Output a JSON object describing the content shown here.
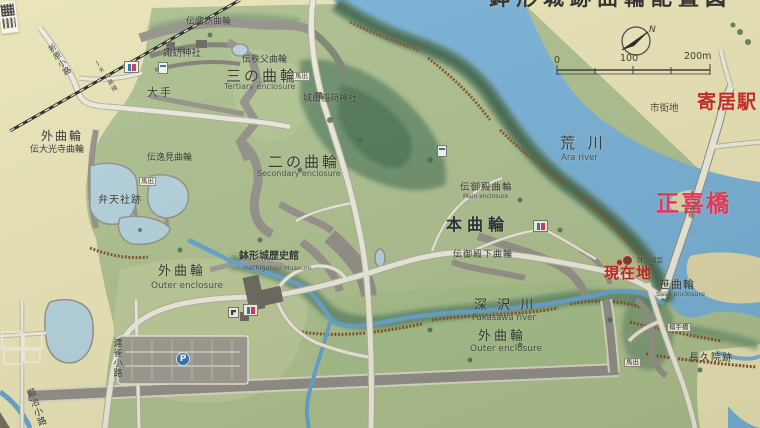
{
  "sign": {
    "type": "castle-site-guide-map"
  },
  "compass": {
    "north_label": "N"
  },
  "scale_bar": {
    "ticks": [
      "0",
      "100",
      "200m"
    ]
  },
  "icons": {
    "parking_letter": "P"
  },
  "colors": {
    "water": "#72aed8",
    "grass": "#a9bd8c",
    "cream": "#e7e2b4",
    "label_ink": "#262c30",
    "label_red": "#cc1414",
    "station_red": "#c32020",
    "bridge_pink": "#e82e5a"
  },
  "labels": [
    {
      "n": "map-title",
      "t": "鉢形城跡曲輪配置図",
      "x": 489,
      "y": -12,
      "fs": 21,
      "b": 1,
      "ls": 6,
      "c": "#23231f"
    },
    {
      "n": "yorii-station",
      "t": "寄居駅",
      "x": 697,
      "y": 93,
      "fs": 19,
      "b": 1,
      "ls": 1,
      "c": "#c32020"
    },
    {
      "n": "shigaichi",
      "t": "市街地",
      "x": 650,
      "y": 104,
      "fs": 9.5,
      "c": "#3c3a32"
    },
    {
      "n": "arakawa",
      "t": "荒 川",
      "x": 560,
      "y": 136,
      "fs": 15,
      "ls": 4,
      "c": "#25323c"
    },
    {
      "n": "arakawa-en",
      "t": "Ara river",
      "x": 561,
      "y": 154,
      "fs": 8.5,
      "c": "#37464e"
    },
    {
      "n": "shokibashi",
      "t": "正喜橋",
      "x": 656,
      "y": 193,
      "fs": 23,
      "b": 1,
      "ls": 2,
      "c": "#e82e5a"
    },
    {
      "n": "genzaichi",
      "t": "現在地",
      "x": 604,
      "y": 266,
      "fs": 15,
      "b": 1,
      "ls": 1,
      "c": "#cc1414"
    },
    {
      "n": "model-note",
      "t": "鉢形模型",
      "x": 637,
      "y": 257,
      "fs": 6.5,
      "c": "#3a382e"
    },
    {
      "n": "sasa-kuruwa",
      "t": "笹曲輪",
      "x": 659,
      "y": 279,
      "fs": 11,
      "ls": 1
    },
    {
      "n": "sasa-kuruwa-en",
      "t": "Sasa enclosure",
      "x": 656,
      "y": 291,
      "fs": 6.5,
      "c": "#37464e"
    },
    {
      "n": "karamete-bashi",
      "t": "搦手橋",
      "x": 667,
      "y": 323,
      "fs": 6.5,
      "bg": 1
    },
    {
      "n": "chokyuin-ato",
      "t": "長久院跡",
      "x": 689,
      "y": 354,
      "fs": 10,
      "ls": 1
    },
    {
      "n": "umadashi-se",
      "t": "馬出",
      "x": 624,
      "y": 358,
      "fs": 6.5,
      "bg": 1
    },
    {
      "n": "hon-kuruwa",
      "t": "本曲輪",
      "x": 446,
      "y": 217,
      "fs": 16,
      "b": 1,
      "ls": 5,
      "c": "#1b2530"
    },
    {
      "n": "goten-kuruwa",
      "t": "伝御殿曲輪",
      "x": 460,
      "y": 183,
      "fs": 9.5,
      "ls": 1
    },
    {
      "n": "goten-kuruwa-en",
      "t": "Main enclosure",
      "x": 463,
      "y": 194,
      "fs": 6,
      "c": "#37464e"
    },
    {
      "n": "gotenshita-kuruwa",
      "t": "伝御殿下曲輪",
      "x": 453,
      "y": 251,
      "fs": 9,
      "ls": 1
    },
    {
      "n": "ni-no-kuruwa",
      "t": "二の曲輪",
      "x": 268,
      "y": 155,
      "fs": 15,
      "ls": 3
    },
    {
      "n": "ni-no-kuruwa-en",
      "t": "Secondary enclosure",
      "x": 257,
      "y": 170,
      "fs": 8,
      "c": "#37464e"
    },
    {
      "n": "san-no-kuruwa",
      "t": "三の曲輪",
      "x": 226,
      "y": 69,
      "fs": 15,
      "ls": 3
    },
    {
      "n": "san-no-kuruwa-en",
      "t": "Tertiary enclosure",
      "x": 224,
      "y": 83,
      "fs": 8,
      "c": "#37464e"
    },
    {
      "n": "chichibu-kuruwa",
      "t": "伝秩父曲輪",
      "x": 242,
      "y": 56,
      "fs": 9
    },
    {
      "n": "den-suwa-kuruwa",
      "t": "伝諏訪曲輪",
      "x": 186,
      "y": 18,
      "fs": 9
    },
    {
      "n": "suwa-jinja",
      "t": "諏訪神社",
      "x": 163,
      "y": 49,
      "fs": 9.5
    },
    {
      "n": "ote",
      "t": "大手",
      "x": 147,
      "y": 87,
      "fs": 11,
      "ls": 2
    },
    {
      "n": "shiroyama-inari-jinja",
      "t": "城山稲荷神社",
      "x": 303,
      "y": 95,
      "fs": 9
    },
    {
      "n": "umadashi-n",
      "t": "馬出",
      "x": 293,
      "y": 72,
      "fs": 6.5,
      "bg": 1
    },
    {
      "n": "umadashi-w",
      "t": "馬出",
      "x": 139,
      "y": 177,
      "fs": 6.5,
      "bg": 1
    },
    {
      "n": "soto-kuruwa-nw",
      "t": "外曲輪",
      "x": 41,
      "y": 130,
      "fs": 12,
      "ls": 2
    },
    {
      "n": "daikoji-kuruwa",
      "t": "伝大光寺曲輪",
      "x": 30,
      "y": 146,
      "fs": 9
    },
    {
      "n": "henmi-kuruwa",
      "t": "伝逸見曲輪",
      "x": 147,
      "y": 154,
      "fs": 9
    },
    {
      "n": "benten-sha-ato",
      "t": "弁天社跡",
      "x": 98,
      "y": 196,
      "fs": 10,
      "ls": 1
    },
    {
      "n": "soto-kuruwa-w",
      "t": "外曲輪",
      "x": 158,
      "y": 265,
      "fs": 13,
      "ls": 3
    },
    {
      "n": "soto-kuruwa-w-en",
      "t": "Outer enclosure",
      "x": 151,
      "y": 282,
      "fs": 9,
      "c": "#37464e"
    },
    {
      "n": "museum",
      "t": "鉢形城歴史館",
      "x": 239,
      "y": 252,
      "fs": 10,
      "b": 1
    },
    {
      "n": "museum-en",
      "t": "Hachigatajo Museum",
      "x": 243,
      "y": 265,
      "fs": 6.5,
      "c": "#37464e"
    },
    {
      "n": "fukasawa-gawa",
      "t": "深 沢 川",
      "x": 474,
      "y": 299,
      "fs": 13,
      "ls": 3
    },
    {
      "n": "fukasawa-gawa-en",
      "t": "Fukasawa river",
      "x": 472,
      "y": 314,
      "fs": 8.5,
      "c": "#37464e"
    },
    {
      "n": "soto-kuruwa-s",
      "t": "外曲輪",
      "x": 478,
      "y": 330,
      "fs": 13,
      "ls": 3
    },
    {
      "n": "soto-kuruwa-s-en",
      "t": "Outer enclosure",
      "x": 470,
      "y": 345,
      "fs": 9,
      "c": "#37464e"
    },
    {
      "n": "renjaku-koji",
      "t": "連雀小路",
      "x": 111,
      "y": 338,
      "fs": 9,
      "v": 1
    },
    {
      "n": "kaji-koji",
      "t": "鍛冶小路",
      "x": 30,
      "y": 388,
      "fs": 9,
      "v": 1,
      "r": -20
    },
    {
      "n": "orihara-koji",
      "t": "折原小路",
      "x": 55,
      "y": 42,
      "fs": 8,
      "v": 1,
      "r": -32
    },
    {
      "n": "jr-hachiko-line",
      "t": "JR八高線",
      "x": 102,
      "y": 58,
      "fs": 6,
      "v": 1,
      "r": -32,
      "c": "#3a382e"
    },
    {
      "n": "shokibashi-small",
      "t": "正喜橋",
      "x": 688,
      "y": 198,
      "fs": 6,
      "v": 1,
      "r": 15,
      "c": "#3a382e"
    }
  ],
  "markers": [
    {
      "n": "toilet-icon-suwa",
      "type": "toilet",
      "x": 124,
      "y": 61
    },
    {
      "n": "guide-sign-icon-suwa",
      "type": "sign",
      "x": 158,
      "y": 62
    },
    {
      "n": "toilet-icon-honkuruwa",
      "type": "toilet",
      "x": 533,
      "y": 220
    },
    {
      "n": "toilet-icon-museum",
      "type": "toilet",
      "x": 243,
      "y": 304
    },
    {
      "n": "faucet-icon-museum",
      "type": "faucet",
      "x": 228,
      "y": 307
    },
    {
      "n": "parking-icon",
      "type": "parking",
      "x": 176,
      "y": 352
    },
    {
      "n": "you-are-here-dot",
      "type": "here",
      "x": 622,
      "y": 255
    },
    {
      "n": "viewpoint-marker",
      "type": "sign",
      "x": 437,
      "y": 145
    }
  ]
}
